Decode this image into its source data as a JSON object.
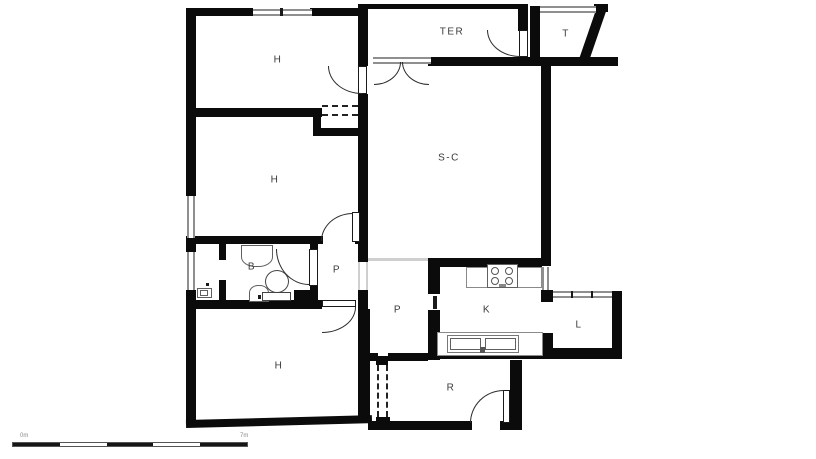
{
  "rooms": {
    "h1": "H",
    "h2": "H",
    "h3": "H",
    "ter": "TER",
    "t": "T",
    "sc": "S-C",
    "b": "B",
    "p1": "P",
    "p2": "P",
    "k": "K",
    "l": "L",
    "r": "R"
  },
  "scale_bar": {
    "start": "0m",
    "end": "7m"
  },
  "colors": {
    "wall": "#0b0b0b",
    "window": "#8f8f8f",
    "opening": "#cfcfcf",
    "label": "#3a3a3a",
    "background": "#ffffff"
  },
  "icons": [
    "stove-icon",
    "kitchen-sink-icon",
    "washbasin-icon",
    "bidet-icon",
    "toilet-icon"
  ]
}
